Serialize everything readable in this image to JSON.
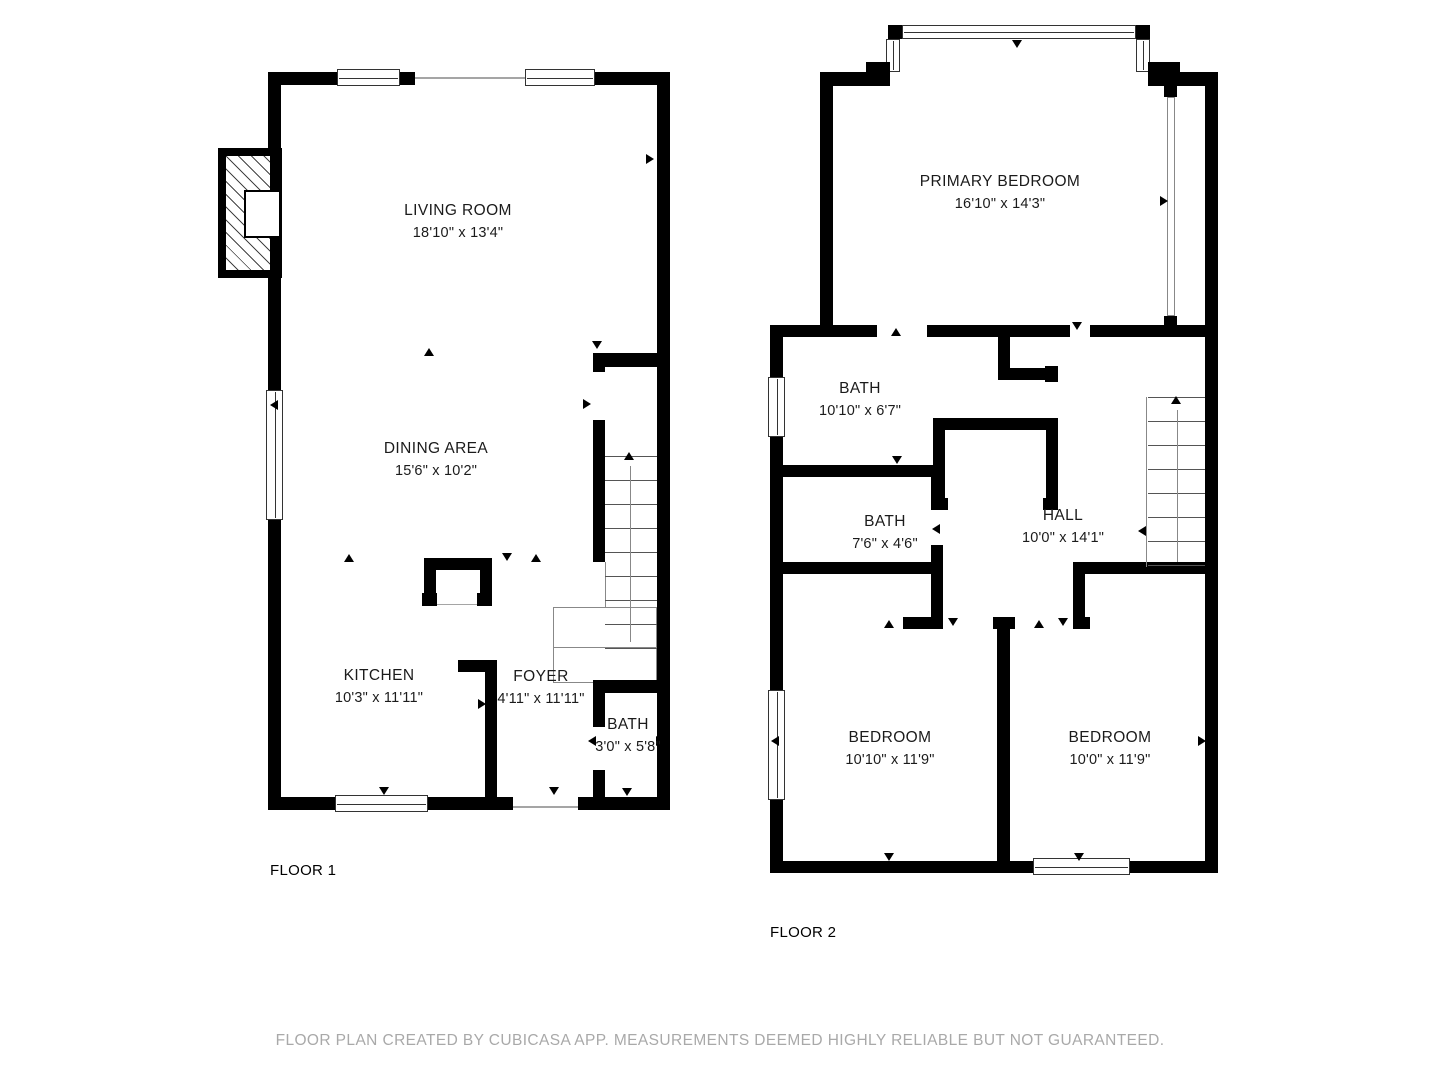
{
  "floor1": {
    "label": "FLOOR 1",
    "rooms": [
      {
        "name": "LIVING ROOM",
        "dims": "18'10\" x 13'4\""
      },
      {
        "name": "DINING AREA",
        "dims": "15'6\" x 10'2\""
      },
      {
        "name": "KITCHEN",
        "dims": "10'3\" x 11'11\""
      },
      {
        "name": "FOYER",
        "dims": "4'11\" x 11'11\""
      },
      {
        "name": "BATH",
        "dims": "3'0\" x 5'8\""
      }
    ]
  },
  "floor2": {
    "label": "FLOOR 2",
    "rooms": [
      {
        "name": "PRIMARY BEDROOM",
        "dims": "16'10\" x 14'3\""
      },
      {
        "name": "BATH",
        "dims": "10'10\" x 6'7\""
      },
      {
        "name": "BATH",
        "dims": "7'6\" x 4'6\""
      },
      {
        "name": "HALL",
        "dims": "10'0\" x 14'1\""
      },
      {
        "name": "BEDROOM",
        "dims": "10'10\" x 11'9\""
      },
      {
        "name": "BEDROOM",
        "dims": "10'0\" x 11'9\""
      }
    ]
  },
  "footer": {
    "text": "FLOOR PLAN CREATED BY CUBICASA APP. MEASUREMENTS DEEMED HIGHLY RELIABLE BUT NOT GUARANTEED."
  },
  "colors": {
    "wall": "#000000",
    "window_frame": "#333333",
    "stair_tread": "#555555",
    "footer_text": "#a9a9a9"
  }
}
